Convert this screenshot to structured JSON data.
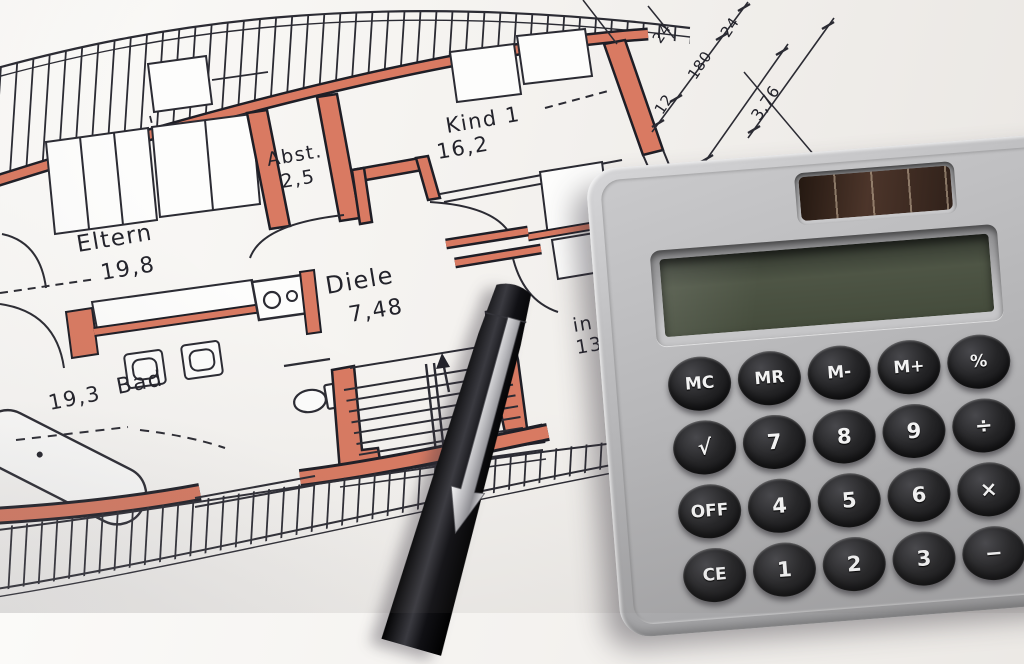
{
  "scene": {
    "description": "Photo: German architectural floor plan (red-marked walls) with a solar pocket calculator and a black ballpoint pen lying on it"
  },
  "floor_plan": {
    "rooms": {
      "eltern": {
        "name": "Eltern",
        "area": "19,8"
      },
      "abst": {
        "name": "Abst.",
        "area": "2,5"
      },
      "kind1": {
        "name": "Kind 1",
        "area": "16,2"
      },
      "diele": {
        "name": "Diele",
        "area": "7,48"
      },
      "bad": {
        "name": "Bad",
        "area": "19,3"
      },
      "partial": {
        "name": "in",
        "area": "13,"
      }
    },
    "dimensions": [
      "24",
      "24",
      "180",
      "12",
      "3,76"
    ],
    "wall_highlight_color": "#d97a62",
    "line_color": "#23232b"
  },
  "calculator": {
    "display_value": "",
    "body_color": "#b0b0b2",
    "key_color": "#1b1b1d",
    "solar_panel_color": "#3a2a20",
    "lcd_color": "#49503f",
    "buttons": [
      [
        "MC",
        "MR",
        "M-",
        "M+",
        "%"
      ],
      [
        "√",
        "7",
        "8",
        "9",
        "÷"
      ],
      [
        "OFF",
        "4",
        "5",
        "6",
        "×"
      ],
      [
        "CE",
        "1",
        "2",
        "3",
        "−"
      ]
    ]
  },
  "pen": {
    "description": "black ballpoint pen with silver arrow clip"
  }
}
